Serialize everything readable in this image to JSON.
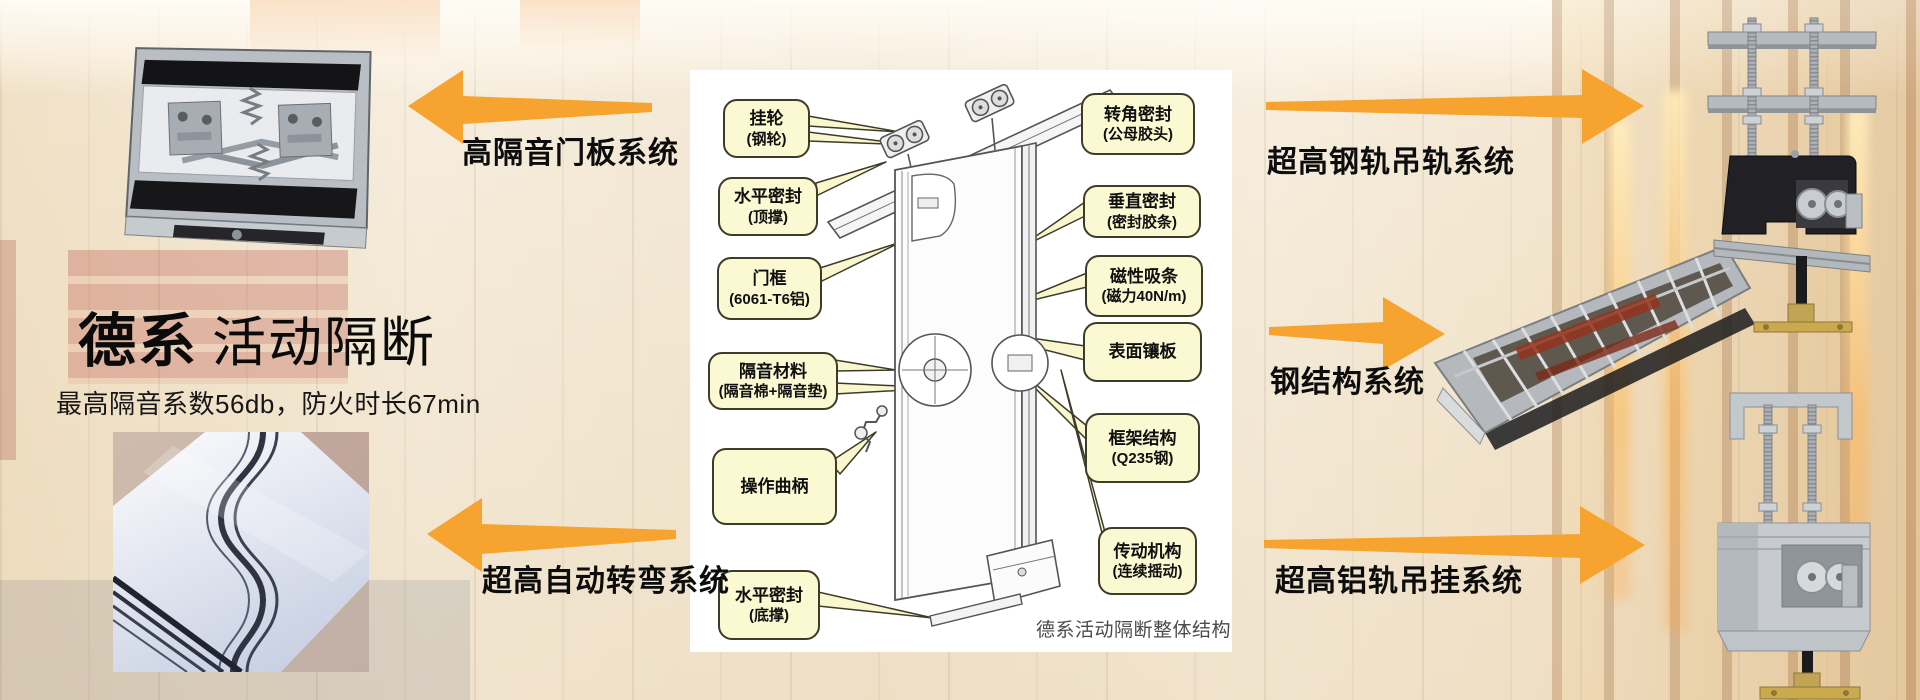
{
  "header": {
    "brand": "德系",
    "product": "活动隔断",
    "subtitle": "最高隔音系数56db，防火时长67min"
  },
  "systems": {
    "door_panel": "高隔音门板系统",
    "auto_turn": "超高自动转弯系统",
    "steel_rail": "超高钢轨吊轨系统",
    "steel_structure": "钢结构系统",
    "alu_rail": "超高铝轨吊挂系统"
  },
  "diagram": {
    "caption": "德系活动隔断整体结构",
    "left": [
      {
        "l1": "挂轮",
        "l2": "(钢轮)"
      },
      {
        "l1": "水平密封",
        "l2": "(顶撑)"
      },
      {
        "l1": "门框",
        "l2": "(6061-T6铝)"
      },
      {
        "l1": "隔音材料",
        "l2": "(隔音棉+隔音垫)"
      },
      {
        "l1": "操作曲柄",
        "l2": ""
      },
      {
        "l1": "水平密封",
        "l2": "(底撑)"
      }
    ],
    "right": [
      {
        "l1": "转角密封",
        "l2": "(公母胶头)"
      },
      {
        "l1": "垂直密封",
        "l2": "(密封胶条)"
      },
      {
        "l1": "磁性吸条",
        "l2": "(磁力40N/m)"
      },
      {
        "l1": "表面镶板",
        "l2": ""
      },
      {
        "l1": "框架结构",
        "l2": "(Q235钢)"
      },
      {
        "l1": "传动机构",
        "l2": "(连续摇动)"
      }
    ]
  },
  "colors": {
    "arrow": "#F6A42F",
    "callout_bg": "#FBF9D2",
    "callout_border": "#3C3C28",
    "panel_bg": "#FFFFFF"
  }
}
